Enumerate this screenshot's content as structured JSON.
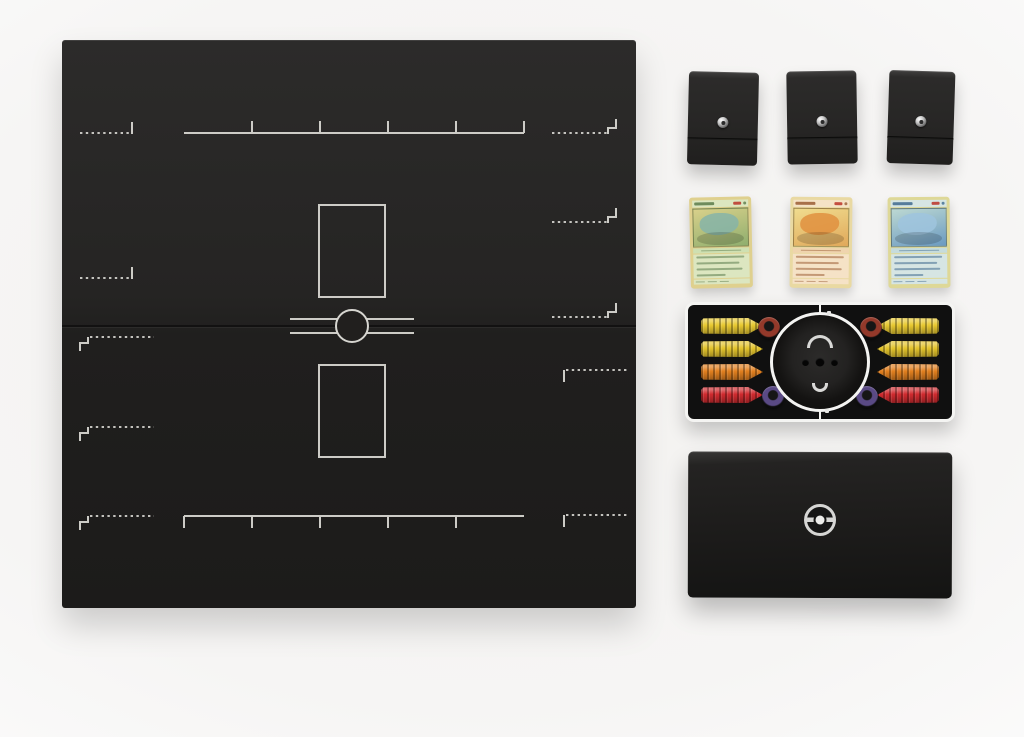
{
  "photo": {
    "description": "Product photo of a black Pokemon trading card game set: folding game board with white card-zone markings, three black deck boxes with metal pokeball pins, three vintage cards (green, orange, blue), accessory tray with damage counters around a pokeball compartment, and a black storage box with a silver pokeball emblem",
    "background": "#f2f1ef"
  },
  "board": {
    "label": "folding game board",
    "bg": "#232221",
    "line_color": "#d6d5d0",
    "bench_slots": 5,
    "active_spots": 2,
    "center_icon": "pokeball-outline-icon"
  },
  "deck_boxes": {
    "count": 3,
    "color": "#272625",
    "pin_icon": "metal-pokeball-pin-icon"
  },
  "cards": [
    {
      "id": "green-card",
      "border": "#dfd08e",
      "body": "#dce6c0",
      "body2": "#cfe0b2",
      "art1": "#d8d08a",
      "art2": "#8fae6e",
      "blob": "#86b4a8",
      "line": "#5a7a4a"
    },
    {
      "id": "orange-card",
      "border": "#e9d9a2",
      "body": "#f5e2c6",
      "body2": "#efd4ae",
      "art1": "#f0dc8e",
      "art2": "#e0a85a",
      "blob": "#e09040",
      "line": "#9a5c34"
    },
    {
      "id": "blue-card",
      "border": "#ded897",
      "body": "#d6e5e3",
      "body2": "#c6dcdc",
      "art1": "#bcd8d2",
      "art2": "#6b9ac1",
      "blob": "#9fc4de",
      "line": "#3f6a8e"
    }
  ],
  "tray": {
    "border": "#f4f4f2",
    "bg": "#101010",
    "center": "pokeball-compartment",
    "counters": {
      "left": [
        "#e8c930",
        "#e4c42c",
        "#e2801f",
        "#d02b2f"
      ],
      "right": [
        "#e8c930",
        "#e4c42c",
        "#e2801f",
        "#d02b2f"
      ]
    },
    "rings": {
      "top": "#93392a",
      "bottom": "#5a4a85"
    }
  },
  "storage_box": {
    "bg": "#1d1c1b",
    "emblem_icon": "silver-pokeball-emblem-icon"
  }
}
